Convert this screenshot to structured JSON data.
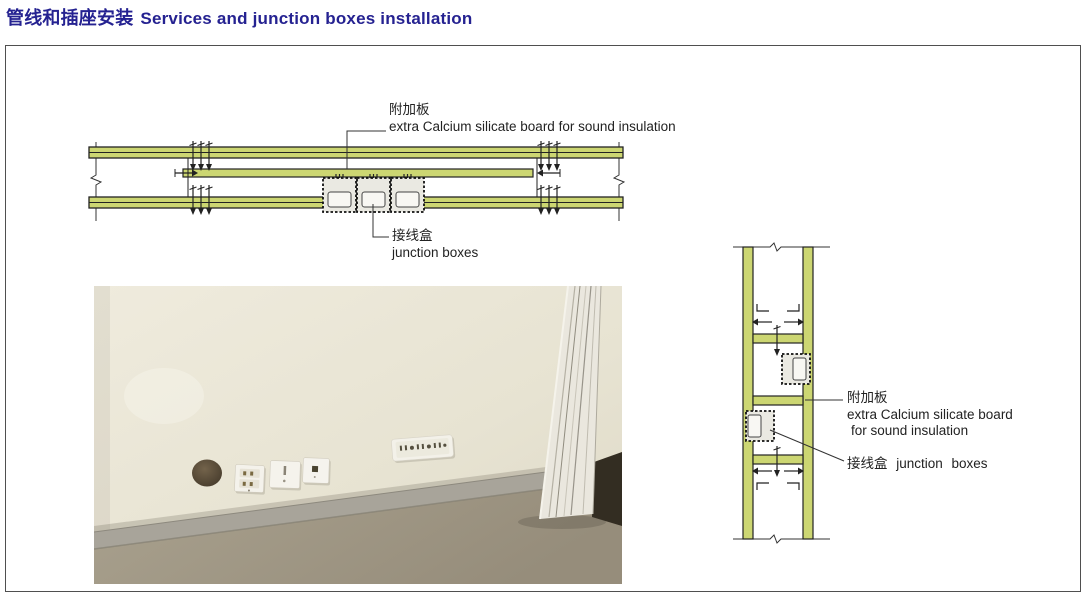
{
  "title": {
    "zh": "管线和插座安装",
    "en": "Services and junction boxes installation"
  },
  "top_diagram": {
    "extra_board_label_zh": "附加板",
    "extra_board_label_en": "extra Calcium silicate board for sound insulation",
    "junction_label_zh": "接线盒",
    "junction_label_en": "junction boxes"
  },
  "side_diagram": {
    "extra_board_label_zh": "附加板",
    "extra_board_label_en_1": "extra Calcium silicate board",
    "extra_board_label_en_2": "for sound insulation",
    "junction_label": "接线盒 junction boxes"
  },
  "colors": {
    "title_navy": "#252291",
    "board_green": "#ccd672",
    "line_black": "#222222",
    "frame_gray": "#4f4f4f",
    "photo_wall_cream": "#e8e4d3",
    "photo_floor_tan": "#a39a87",
    "photo_skirting_gray": "#a8a49a"
  }
}
